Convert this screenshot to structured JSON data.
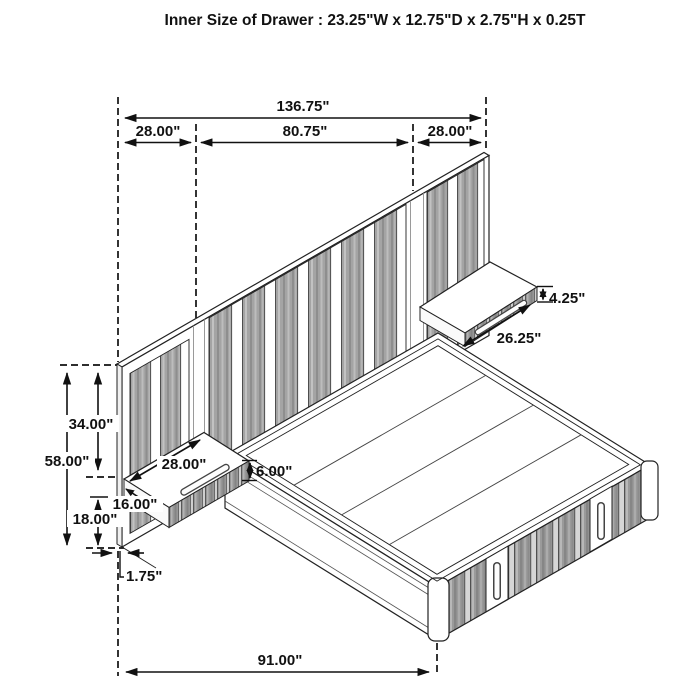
{
  "title": "Inner Size of Drawer : 23.25\"W x 12.75\"D x 2.75\"H x 0.25T",
  "dims": {
    "total_width": "136.75\"",
    "left_section_width": "28.00\"",
    "center_section_width": "80.75\"",
    "right_section_width": "28.00\"",
    "right_nightstand_height": "4.25\"",
    "right_nightstand_width": "26.25\"",
    "headboard_upper_height": "34.00\"",
    "headboard_total_height": "58.00\"",
    "left_nightstand_width": "28.00\"",
    "left_nightstand_height": "6.00\"",
    "left_nightstand_depth": "16.00\"",
    "headboard_lower_height": "18.00\"",
    "panel_thickness": "1.75\"",
    "bed_length": "91.00\""
  }
}
